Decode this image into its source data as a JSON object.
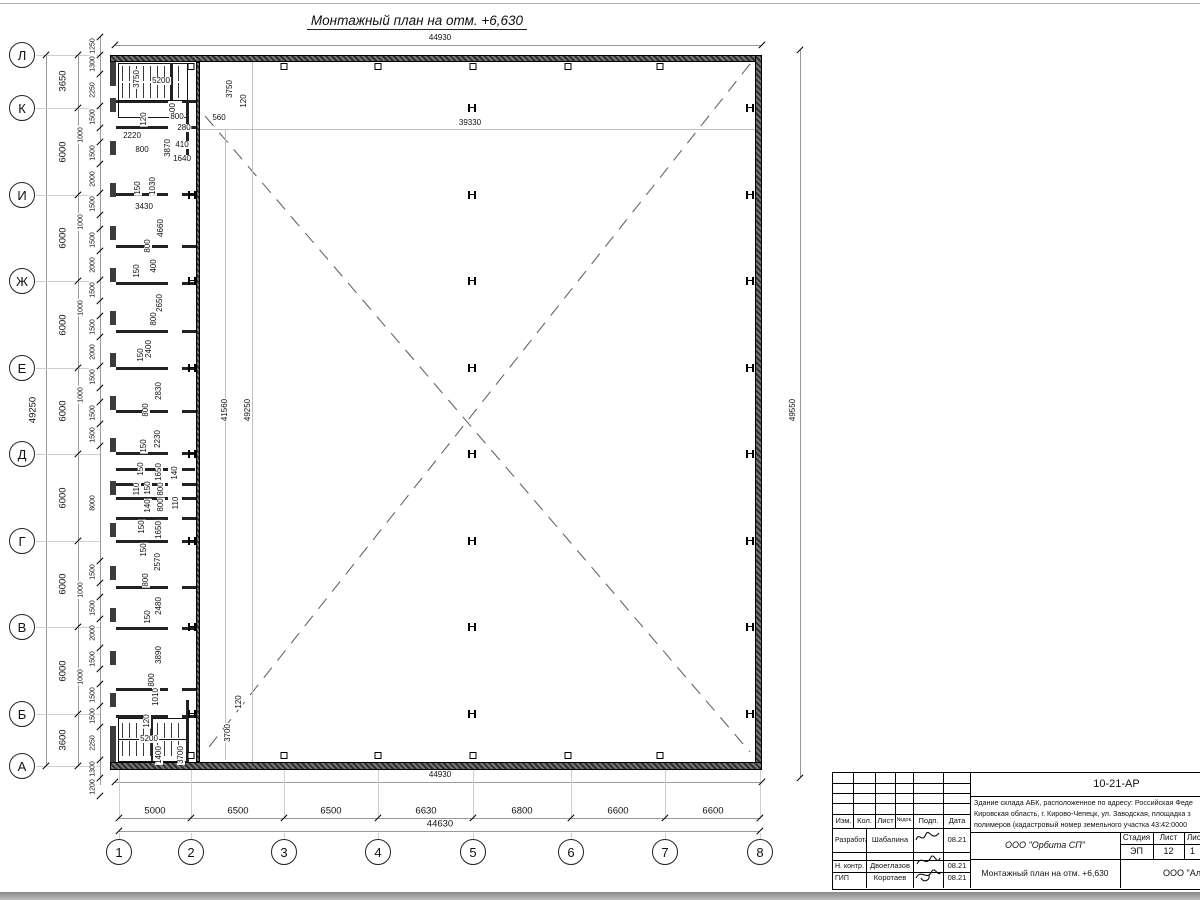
{
  "sheet": {
    "title": "Монтажный план на отм. +6,630"
  },
  "drawing": {
    "rows": [
      {
        "l": "Л",
        "y": 55
      },
      {
        "l": "К",
        "y": 108
      },
      {
        "l": "И",
        "y": 195
      },
      {
        "l": "Ж",
        "y": 281
      },
      {
        "l": "Е",
        "y": 368
      },
      {
        "l": "Д",
        "y": 454
      },
      {
        "l": "Г",
        "y": 541
      },
      {
        "l": "В",
        "y": 627
      },
      {
        "l": "Б",
        "y": 714
      },
      {
        "l": "А",
        "y": 766
      }
    ],
    "cols": [
      {
        "l": "1",
        "x": 119
      },
      {
        "l": "2",
        "x": 191
      },
      {
        "l": "3",
        "x": 284
      },
      {
        "l": "4",
        "x": 378
      },
      {
        "l": "5",
        "x": 473
      },
      {
        "l": "6",
        "x": 571
      },
      {
        "l": "7",
        "x": 665
      },
      {
        "l": "8",
        "x": 760
      }
    ],
    "row_spans": [
      {
        "t": "3650",
        "y": 81
      },
      {
        "t": "6000",
        "y": 152
      },
      {
        "t": "6000",
        "y": 238
      },
      {
        "t": "6000",
        "y": 325
      },
      {
        "t": "6000",
        "y": 411
      },
      {
        "t": "6000",
        "y": 498
      },
      {
        "t": "6000",
        "y": 584
      },
      {
        "t": "6000",
        "y": 671
      },
      {
        "t": "3600",
        "y": 740
      }
    ],
    "col_spans": [
      {
        "t": "5000",
        "x": 155
      },
      {
        "t": "6500",
        "x": 238
      },
      {
        "t": "6500",
        "x": 331
      },
      {
        "t": "6630",
        "x": 426
      },
      {
        "t": "6800",
        "x": 522
      },
      {
        "t": "6600",
        "x": 618
      },
      {
        "t": "6600",
        "x": 713
      }
    ],
    "totals": {
      "top": "44930",
      "bottom_outer": "44930",
      "bottom": "44630",
      "left": "49250",
      "right": "49550"
    },
    "window_chain": [
      1250,
      1300,
      2250,
      1500,
      1000,
      1500,
      2000,
      1500,
      1000,
      1500,
      2000,
      1500,
      1000,
      1500,
      2000,
      1500,
      1000,
      1500,
      1500,
      8000,
      1500,
      1000,
      1500,
      2000,
      1500,
      1000,
      1500,
      1500,
      2250,
      1300,
      1200
    ],
    "labels": [
      {
        "t": "3750",
        "x": 137,
        "y": 79,
        "r": 1
      },
      {
        "t": "5200",
        "x": 161,
        "y": 81,
        "r": 0
      },
      {
        "t": "1400",
        "x": 173,
        "y": 112,
        "r": 1
      },
      {
        "t": "120",
        "x": 144,
        "y": 119,
        "r": 1
      },
      {
        "t": "800",
        "x": 177,
        "y": 117,
        "r": 0
      },
      {
        "t": "280",
        "x": 184,
        "y": 128,
        "r": 0
      },
      {
        "t": "560",
        "x": 219,
        "y": 118,
        "r": 0
      },
      {
        "t": "2220",
        "x": 132,
        "y": 136,
        "r": 0
      },
      {
        "t": "800",
        "x": 142,
        "y": 150,
        "r": 0
      },
      {
        "t": "3870",
        "x": 168,
        "y": 148,
        "r": 1
      },
      {
        "t": "410",
        "x": 182,
        "y": 145,
        "r": 0
      },
      {
        "t": "1640",
        "x": 182,
        "y": 159,
        "r": 0
      },
      {
        "t": "3750",
        "x": 230,
        "y": 89,
        "r": 1
      },
      {
        "t": "120",
        "x": 244,
        "y": 101,
        "r": 1
      },
      {
        "t": "150",
        "x": 138,
        "y": 188,
        "r": 1
      },
      {
        "t": "1030",
        "x": 153,
        "y": 186,
        "r": 1
      },
      {
        "t": "3430",
        "x": 144,
        "y": 207,
        "r": 0
      },
      {
        "t": "4660",
        "x": 161,
        "y": 228,
        "r": 1
      },
      {
        "t": "800",
        "x": 148,
        "y": 246,
        "r": 1
      },
      {
        "t": "400",
        "x": 154,
        "y": 266,
        "r": 1
      },
      {
        "t": "150",
        "x": 137,
        "y": 271,
        "r": 1
      },
      {
        "t": "2650",
        "x": 160,
        "y": 303,
        "r": 1
      },
      {
        "t": "800",
        "x": 154,
        "y": 319,
        "r": 1
      },
      {
        "t": "2400",
        "x": 149,
        "y": 349,
        "r": 1
      },
      {
        "t": "150",
        "x": 141,
        "y": 355,
        "r": 1
      },
      {
        "t": "2830",
        "x": 159,
        "y": 391,
        "r": 1
      },
      {
        "t": "800",
        "x": 146,
        "y": 410,
        "r": 1
      },
      {
        "t": "2230",
        "x": 158,
        "y": 439,
        "r": 1
      },
      {
        "t": "150",
        "x": 144,
        "y": 446,
        "r": 1
      },
      {
        "t": "150",
        "x": 141,
        "y": 469,
        "r": 1
      },
      {
        "t": "1650",
        "x": 159,
        "y": 472,
        "r": 1
      },
      {
        "t": "140",
        "x": 175,
        "y": 473,
        "r": 1
      },
      {
        "t": "110",
        "x": 137,
        "y": 489,
        "r": 1
      },
      {
        "t": "150",
        "x": 148,
        "y": 488,
        "r": 1
      },
      {
        "t": "800",
        "x": 161,
        "y": 489,
        "r": 1
      },
      {
        "t": "140",
        "x": 148,
        "y": 506,
        "r": 1
      },
      {
        "t": "110",
        "x": 176,
        "y": 503,
        "r": 1
      },
      {
        "t": "800",
        "x": 161,
        "y": 505,
        "r": 1
      },
      {
        "t": "150",
        "x": 142,
        "y": 527,
        "r": 1
      },
      {
        "t": "1650",
        "x": 159,
        "y": 530,
        "r": 1
      },
      {
        "t": "150",
        "x": 144,
        "y": 550,
        "r": 1
      },
      {
        "t": "2570",
        "x": 158,
        "y": 562,
        "r": 1
      },
      {
        "t": "800",
        "x": 146,
        "y": 580,
        "r": 1
      },
      {
        "t": "2480",
        "x": 159,
        "y": 606,
        "r": 1
      },
      {
        "t": "150",
        "x": 148,
        "y": 617,
        "r": 1
      },
      {
        "t": "3890",
        "x": 159,
        "y": 655,
        "r": 1
      },
      {
        "t": "800",
        "x": 152,
        "y": 680,
        "r": 1
      },
      {
        "t": "1010",
        "x": 156,
        "y": 697,
        "r": 1
      },
      {
        "t": "120",
        "x": 147,
        "y": 721,
        "r": 1
      },
      {
        "t": "120",
        "x": 239,
        "y": 702,
        "r": 1
      },
      {
        "t": "3700",
        "x": 228,
        "y": 733,
        "r": 1
      },
      {
        "t": "5200",
        "x": 149,
        "y": 739,
        "r": 0
      },
      {
        "t": "1400",
        "x": 159,
        "y": 755,
        "r": 1
      },
      {
        "t": "3700",
        "x": 181,
        "y": 755,
        "r": 1
      },
      {
        "t": "39330",
        "x": 470,
        "y": 123,
        "r": 0
      },
      {
        "t": "41560",
        "x": 225,
        "y": 410,
        "r": 1
      },
      {
        "t": "49250",
        "x": 248,
        "y": 410,
        "r": 1
      },
      {
        "t": "49550",
        "x": 793,
        "y": 410,
        "r": 1
      }
    ],
    "partitions": [
      100,
      126,
      193,
      245,
      282,
      330,
      367,
      410,
      452,
      468,
      483,
      497,
      517,
      540,
      586,
      627,
      688,
      715
    ],
    "door_gaps": [
      136,
      205,
      292,
      378,
      464,
      551,
      637,
      700
    ],
    "square_cols": [
      191,
      284,
      378,
      473,
      568,
      660
    ]
  },
  "titleblock": {
    "code": "10-21-АР",
    "address_lines": [
      "Здание склада АБК, расположенное по адресу: Российская Феде",
      "Кировская область, г. Кирово-Чепецк, ул. Заводская, площадка з",
      "полимеров (кадастровый номер земельного участка 43:42:0000"
    ],
    "header_cols": [
      "Изм.",
      "Кол.",
      "Лист",
      "№док.",
      "Подп.",
      "Дата"
    ],
    "rows": [
      {
        "role": "Разработал",
        "name": "Шабалина",
        "date": "08.21"
      },
      {
        "role": "Н. контр.",
        "name": "Двоеглазов",
        "date": "08.21"
      },
      {
        "role": "ГИП",
        "name": "Коротаев",
        "date": "08.21"
      }
    ],
    "org": "ООО \"Орбита СП\"",
    "doc_title": "Монтажный план на отм. +6,630",
    "org2": "ООО \"Альянс",
    "stage_label": "Стадия",
    "sheet_label": "Лист",
    "sheets_label": "Листов",
    "stage": "ЭП",
    "sheet": "12",
    "sheets": "1"
  }
}
